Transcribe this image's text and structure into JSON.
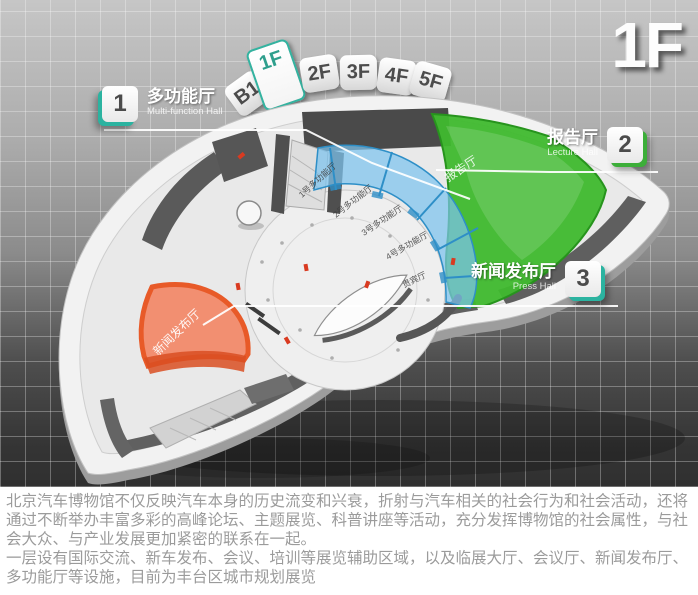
{
  "header": {
    "floor_indicator": "1F"
  },
  "floor_tabs": [
    {
      "label": "B1",
      "active": false
    },
    {
      "label": "1F",
      "active": true
    },
    {
      "label": "2F",
      "active": false
    },
    {
      "label": "3F",
      "active": false
    },
    {
      "label": "4F",
      "active": false
    },
    {
      "label": "5F",
      "active": false
    }
  ],
  "legend": [
    {
      "number": "1",
      "name_zh": "多功能厅",
      "name_en": "Multi-function Hall",
      "accent_color": "#2bb3a0"
    },
    {
      "number": "2",
      "name_zh": "报告厅",
      "name_en": "Lecture Hall",
      "accent_color": "#3cae39"
    },
    {
      "number": "3",
      "name_zh": "新闻发布厅",
      "name_en": "Press Hall",
      "accent_color": "#2bb3a0"
    }
  ],
  "map": {
    "zones": [
      {
        "id": "multifunction",
        "label": "多功能厅",
        "color": "#7dc4ee"
      },
      {
        "id": "lecture",
        "label": "报告厅",
        "color": "#3fb92e"
      },
      {
        "id": "press",
        "label": "新闻发布厅",
        "color": "#f4764e"
      }
    ],
    "rooms": [
      {
        "label": "1号多功能厅"
      },
      {
        "label": "2号多功能厅"
      },
      {
        "label": "3号多功能厅"
      },
      {
        "label": "4号多功能厅"
      },
      {
        "label": "贵宾厅"
      }
    ]
  },
  "caption": {
    "paragraph1": "北京汽车博物馆不仅反映汽车本身的历史流变和兴衰，折射与汽车相关的社会行为和社会活动，还将通过不断举办丰富多彩的高峰论坛、主题展览、科普讲座等活动，充分发挥博物馆的社会属性，与社会大众、与产业发展更加紧密的联系在一起。",
    "paragraph2": "一层设有国际交流、新车发布、会议、培训等展览辅助区域，以及临展大厅、会议厅、新闻发布厅、多功能厅等设施，目前为丰台区城市规划展览"
  }
}
